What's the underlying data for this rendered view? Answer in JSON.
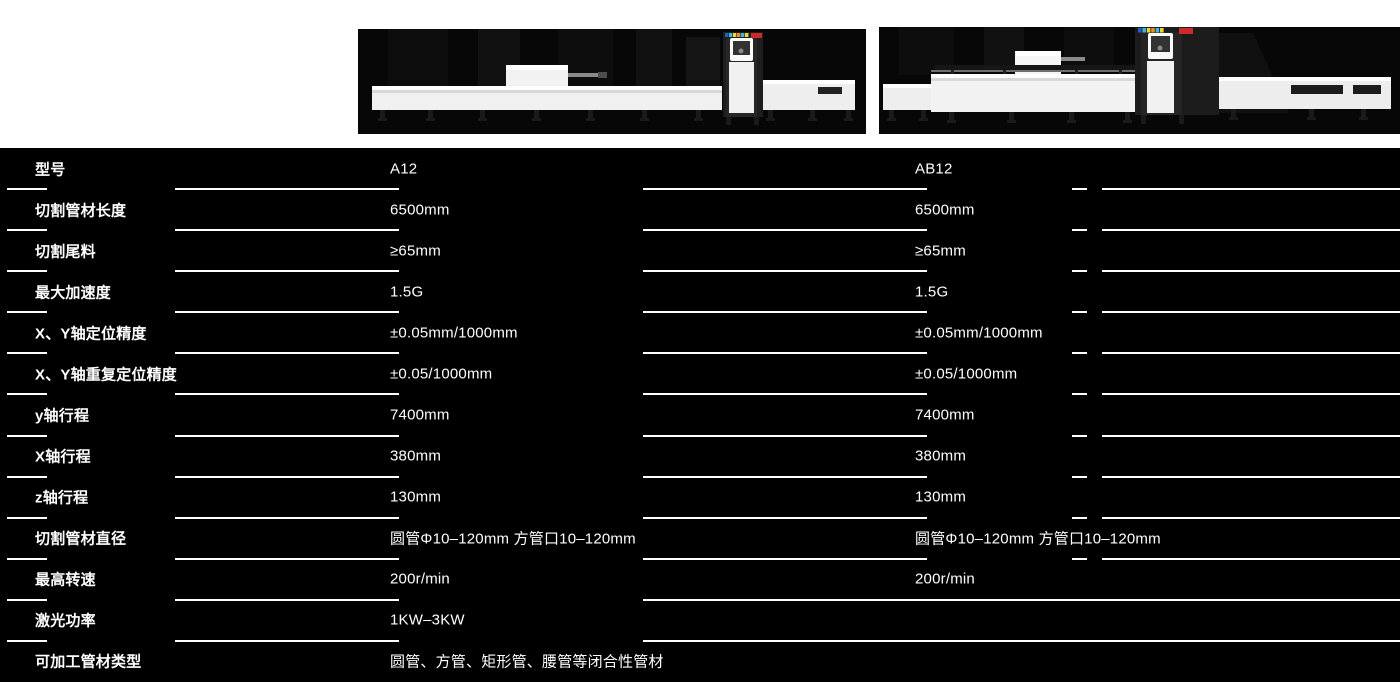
{
  "colors": {
    "page_bg": "#ffffff",
    "panel_bg": "#000000",
    "divider": "#ffffff",
    "text": "#ffffff",
    "machine_body": "#f2f2f2",
    "cabinet": "#1c1c1c",
    "brand_badge": "#cf2a2a"
  },
  "products": [
    {
      "model": "A12",
      "photo_icon": "laser-tube-cutter-a12-photo"
    },
    {
      "model": "AB12",
      "photo_icon": "laser-tube-cutter-ab12-photo"
    }
  ],
  "table": {
    "rows": [
      {
        "label": "型号",
        "a12": "A12",
        "ab12": "AB12"
      },
      {
        "label": "切割管材长度",
        "a12": "6500mm",
        "ab12": "6500mm"
      },
      {
        "label": "切割尾料",
        "a12": "≥65mm",
        "ab12": "≥65mm"
      },
      {
        "label": "最大加速度",
        "a12": "1.5G",
        "ab12": "1.5G"
      },
      {
        "label": "X、Y轴定位精度",
        "a12": "±0.05mm/1000mm",
        "ab12": "±0.05mm/1000mm"
      },
      {
        "label": "X、Y轴重复定位精度",
        "a12": "±0.05/1000mm",
        "ab12": "±0.05/1000mm"
      },
      {
        "label": "y轴行程",
        "a12": "7400mm",
        "ab12": "7400mm"
      },
      {
        "label": "X轴行程",
        "a12": "380mm",
        "ab12": "380mm"
      },
      {
        "label": "z轴行程",
        "a12": "130mm",
        "ab12": "130mm"
      },
      {
        "label": "切割管材直径",
        "a12": "圆管Φ10–120mm 方管口10–120mm",
        "ab12": "圆管Φ10–120mm 方管口10–120mm"
      },
      {
        "label": "最高转速",
        "a12": "200r/min",
        "ab12": "200r/min"
      },
      {
        "label": "激光功率",
        "a12": "1KW–3KW",
        "ab12": ""
      },
      {
        "label": "可加工管材类型",
        "a12": "圆管、方管、矩形管、腰管等闭合性管材",
        "ab12": ""
      }
    ]
  }
}
